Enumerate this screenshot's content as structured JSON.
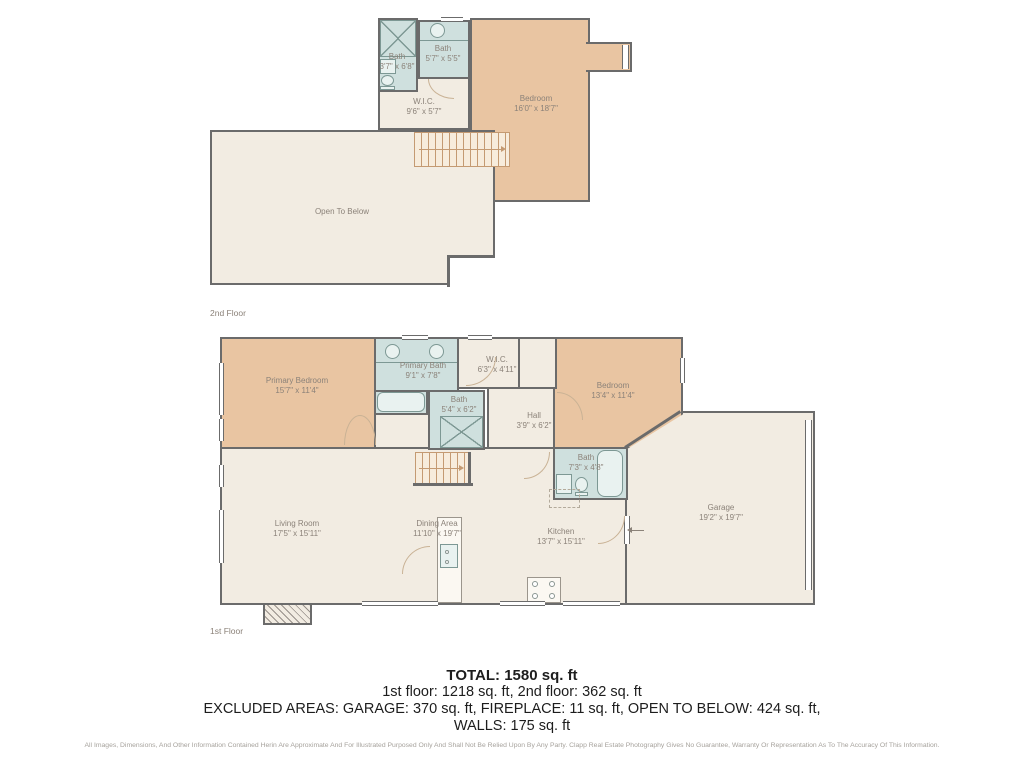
{
  "colors": {
    "wall": "#6b6b6b",
    "room_cream": "#f2ece2",
    "room_tan": "#e9c5a2",
    "room_bath_blue": "#cfe0de",
    "stair_lines": "#c49a72",
    "label_text": "#8b8279",
    "summary_text": "#1d1d1d",
    "disclaimer_text": "#a6a29c"
  },
  "floor2": {
    "label": "2nd Floor",
    "rooms": {
      "bath1": {
        "name": "Bath",
        "dims": "3'7\" x 6'8\""
      },
      "bath2": {
        "name": "Bath",
        "dims": "5'7\" x 5'5\""
      },
      "wic": {
        "name": "W.I.C.",
        "dims": "9'6\" x 5'7\""
      },
      "bedroom": {
        "name": "Bedroom",
        "dims": "16'0\" x 18'7\""
      },
      "open": {
        "name": "Open To Below"
      }
    }
  },
  "floor1": {
    "label": "1st Floor",
    "rooms": {
      "primary_bedroom": {
        "name": "Primary Bedroom",
        "dims": "15'7\" x 11'4\""
      },
      "primary_bath": {
        "name": "Primary Bath",
        "dims": "9'1\" x 7'8\""
      },
      "wic": {
        "name": "W.I.C.",
        "dims": "6'3\" x 4'11\""
      },
      "bath": {
        "name": "Bath",
        "dims": "5'4\" x 6'2\""
      },
      "hall": {
        "name": "Hall",
        "dims": "3'9\" x 6'2\""
      },
      "bedroom": {
        "name": "Bedroom",
        "dims": "13'4\" x 11'4\""
      },
      "bath2": {
        "name": "Bath",
        "dims": "7'3\" x 4'8\""
      },
      "garage": {
        "name": "Garage",
        "dims": "19'2\" x 19'7\""
      },
      "living": {
        "name": "Living Room",
        "dims": "17'5\" x 15'11\""
      },
      "dining": {
        "name": "Dining Area",
        "dims": "11'10\" x 19'7\""
      },
      "kitchen": {
        "name": "Kitchen",
        "dims": "13'7\" x 15'11\""
      }
    }
  },
  "summary": {
    "total": "TOTAL: 1580 sq. ft",
    "floors_line": "1st floor: 1218 sq. ft, 2nd floor: 362 sq. ft",
    "excluded_line": "EXCLUDED AREAS: GARAGE: 370 sq. ft, FIREPLACE: 11 sq. ft, OPEN TO BELOW: 424 sq. ft,",
    "walls_line": "WALLS: 175 sq. ft"
  },
  "disclaimer": "All Images, Dimensions, And Other Information Contained Herin Are Approximate And For Illustrated Purposed Only And Shall Not Be Relied Upon By Any Party. Clapp Real Estate Photography Gives No Guarantee, Warranty Or Representation As To The Accuracy Of This Information."
}
